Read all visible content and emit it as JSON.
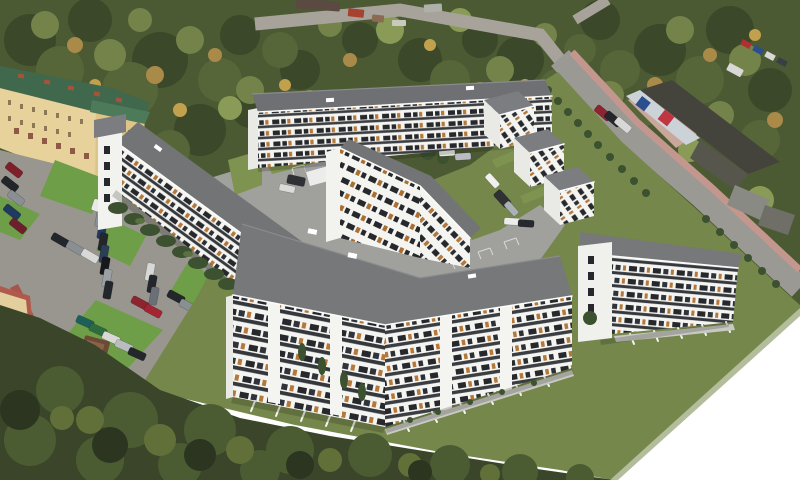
{
  "scene": {
    "type": "architectural-aerial-visualization",
    "description": "Aerial 3D rendering of a new white multi-family housing estate composited onto an aerial photograph: allotment-garden tree canopy at top, an existing yellow apartment block with green roof at left, parking lots full of cars, a commercial hall by a diagonal road at upper right, large L-shaped white apartment buildings with grey flat roofs and timber window accents around a paved courtyard, lawn in front, and the bottom-right corner masked to white.",
    "palette": {
      "canopy_base": "#4b5a33",
      "canopy_dark": "#3b4829",
      "canopy_mid": "#566639",
      "canopy_light": "#73834a",
      "autumn": "#a98a48",
      "autumn_light": "#c2a14e",
      "photo_grass": "#6f9e48",
      "asphalt": "#98968f",
      "road": "#9a9994",
      "top_road": "#a7a39a",
      "sidewalk_red": "#c4978e",
      "footpath_red": "#a8544a",
      "existing_facade": "#e7d29c",
      "existing_roof": "#3f684d",
      "chimney_red": "#a8523a",
      "commercial_roof": "#45443c",
      "commercial_roof2": "#57564c",
      "commercial_front": "#ccd3d8",
      "sign_red": "#c03540",
      "sign_blue": "#2b4f8e",
      "facade_white": "#f4f4f1",
      "end_wall": "#e9e9e5",
      "roof_gray": "#77787a",
      "roof_gray_dark": "#6f7073",
      "roof_gray_mid": "#737476",
      "roof_gray_small": "#7c7d80",
      "window_dark": "#26282c",
      "wood_accent": "#b5783a",
      "render_lawn": "#75874b",
      "lawn_bright": "#7f9350",
      "hedge_green": "#3c5130",
      "paving": "#a0a09d",
      "white_mask": "#ffffff"
    },
    "elements": {
      "tree_canopy": "allotment gardens and tree canopy",
      "existing_building": "existing yellow apartment block with green roof and red chimneys",
      "commercial_building": "commercial hall with dark roof and red/blue signage",
      "main_road": "diagonal street with red paved sidewalk and tree row",
      "parking_area": "asphalt parking lots with parked cars, grass islands, red footpath, waste shelter",
      "development": "new housing estate: north slab, three echelon wings, west slab, inner bent slab, large L-shaped front building, east slab",
      "white_corner": "white mask cropping the render at bottom right"
    },
    "counts": {
      "new_building_masses": 8,
      "floors_visible": "5-6",
      "photo_cars": 38,
      "render_cars": 9,
      "echelon_wings": 3
    },
    "car_colors": [
      "#7e1f2a",
      "#22252a",
      "#8a8f94",
      "#1f3a5e",
      "#6e1f2e",
      "#d8d8d6",
      "#2e6b3f",
      "#1f5f5a",
      "#8e2430",
      "#2f4a6e",
      "#b9bdbf",
      "#e5e5e3"
    ]
  }
}
